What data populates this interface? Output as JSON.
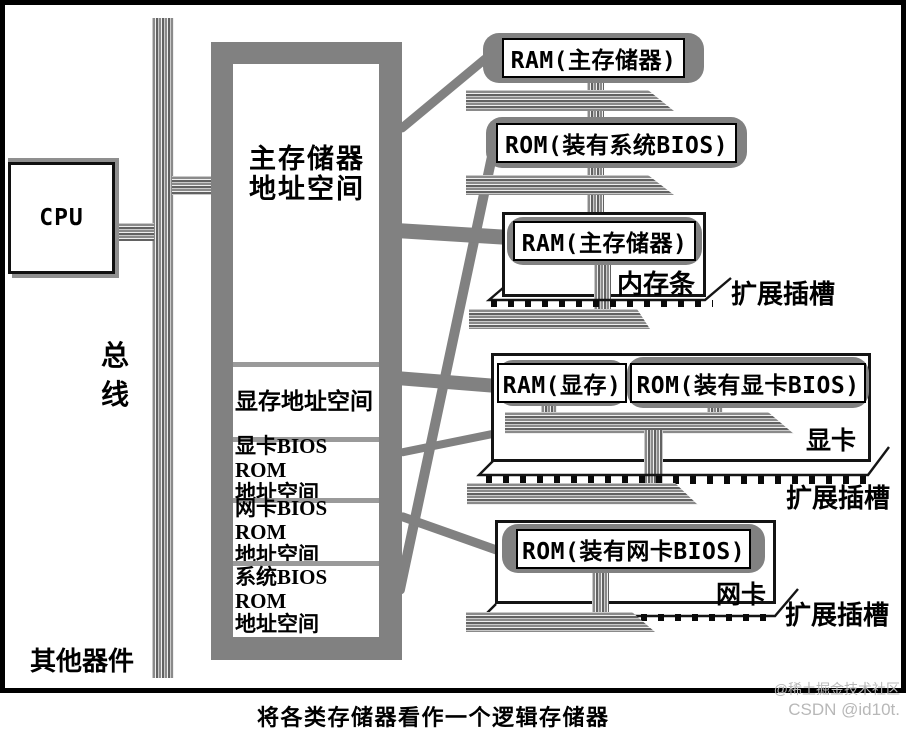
{
  "caption": "将各类存储器看作一个逻辑存储器",
  "cpu": {
    "label": "CPU"
  },
  "bus": {
    "char1": "总",
    "char2": "线"
  },
  "other_devices": {
    "label": "其他器件"
  },
  "address_space": {
    "sections": [
      {
        "line1": "主存储器",
        "line2": "地址空间"
      },
      {
        "line1": "显存地址空间",
        "line2": ""
      },
      {
        "line1": "显卡BIOS ROM",
        "line2": "地址空间"
      },
      {
        "line1": "网卡BIOS ROM",
        "line2": "地址空间"
      },
      {
        "line1": "系统BIOS ROM",
        "line2": "地址空间"
      }
    ]
  },
  "modules": {
    "ram_main_bubble": {
      "label": "RAM(主存储器)"
    },
    "rom_system_bios_bubble": {
      "label": "ROM(装有系统BIOS)"
    },
    "memory_stick_card": {
      "chip": "RAM(主存储器)",
      "name": "内存条",
      "slot": "扩展插槽"
    },
    "video_card": {
      "chip_ram": "RAM(显存)",
      "chip_rom": "ROM(装有显卡BIOS)",
      "name": "显卡",
      "slot": "扩展插槽"
    },
    "network_card": {
      "chip_rom": "ROM(装有网卡BIOS)",
      "name": "网卡",
      "slot": "扩展插槽"
    }
  },
  "watermark": {
    "line1": "@稀土掘金技术社区",
    "line2": "CSDN @id10t."
  },
  "colors": {
    "solid_gray": "#818181",
    "stripe_dark": "#626262",
    "stripe_light": "#c9c9c9",
    "divider_gray": "#9a9a9a",
    "watermark_gray": "#b8b8b8"
  }
}
